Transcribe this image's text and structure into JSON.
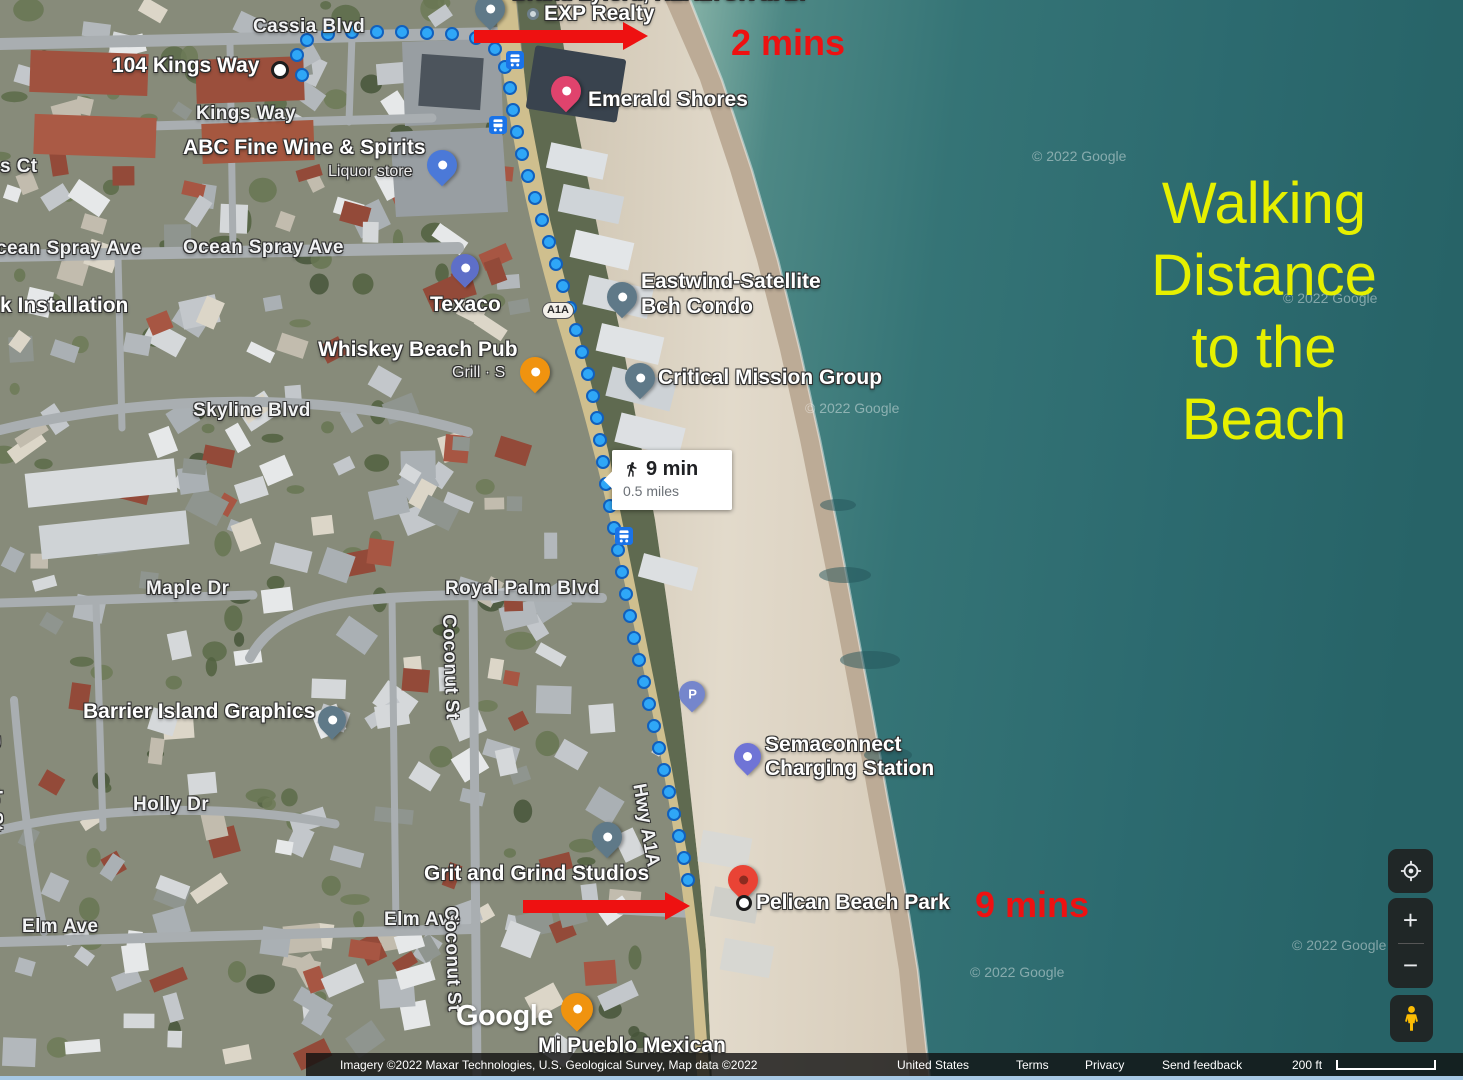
{
  "annotations": {
    "headline": [
      "Walking",
      "Distance",
      "to the",
      "Beach"
    ],
    "headline_color": "#e6f000",
    "arrow_color": "#ee1111",
    "walk_labels": [
      {
        "text": "2 mins",
        "x": 731,
        "y": 22
      },
      {
        "text": "9 mins",
        "x": 975,
        "y": 884
      }
    ],
    "arrows": [
      {
        "x": 474,
        "y": 30,
        "len": 150
      },
      {
        "x": 523,
        "y": 900,
        "len": 143
      }
    ]
  },
  "tooltip": {
    "duration": "9 min",
    "distance": "0.5 miles"
  },
  "route": {
    "color": "#2fa7f7",
    "dots": [
      [
        302,
        75
      ],
      [
        297,
        55
      ],
      [
        307,
        40
      ],
      [
        328,
        34
      ],
      [
        352,
        32
      ],
      [
        377,
        32
      ],
      [
        402,
        32
      ],
      [
        427,
        33
      ],
      [
        452,
        34
      ],
      [
        476,
        38
      ],
      [
        495,
        49
      ],
      [
        505,
        67
      ],
      [
        510,
        88
      ],
      [
        513,
        110
      ],
      [
        517,
        132
      ],
      [
        522,
        154
      ],
      [
        528,
        176
      ],
      [
        535,
        198
      ],
      [
        542,
        220
      ],
      [
        549,
        242
      ],
      [
        556,
        264
      ],
      [
        563,
        286
      ],
      [
        570,
        308
      ],
      [
        576,
        330
      ],
      [
        582,
        352
      ],
      [
        588,
        374
      ],
      [
        593,
        396
      ],
      [
        597,
        418
      ],
      [
        600,
        440
      ],
      [
        603,
        462
      ],
      [
        606,
        484
      ],
      [
        610,
        506
      ],
      [
        614,
        528
      ],
      [
        618,
        550
      ],
      [
        622,
        572
      ],
      [
        626,
        594
      ],
      [
        630,
        616
      ],
      [
        634,
        638
      ],
      [
        639,
        660
      ],
      [
        644,
        682
      ],
      [
        649,
        704
      ],
      [
        654,
        726
      ],
      [
        659,
        748
      ],
      [
        664,
        770
      ],
      [
        669,
        792
      ],
      [
        674,
        814
      ],
      [
        679,
        836
      ],
      [
        684,
        858
      ],
      [
        688,
        880
      ]
    ]
  },
  "transit_stops": [
    [
      515,
      60
    ],
    [
      498,
      125
    ],
    [
      624,
      536
    ]
  ],
  "pins": [
    {
      "name": "exp-realty-pin",
      "x": 490,
      "y": 30,
      "color": "#5f7988",
      "size": 30
    },
    {
      "name": "emerald-shores-pin",
      "x": 566,
      "y": 112,
      "color": "#e0436d",
      "size": 30
    },
    {
      "name": "abc-store-pin",
      "x": 442,
      "y": 186,
      "color": "#4b79d8",
      "size": 30
    },
    {
      "name": "texaco-pin",
      "x": 465,
      "y": 288,
      "color": "#5e6fc8",
      "size": 28
    },
    {
      "name": "whiskey-pub-pin",
      "x": 535,
      "y": 393,
      "color": "#f0930f",
      "size": 30
    },
    {
      "name": "eastwind-pin",
      "x": 622,
      "y": 318,
      "color": "#5f7988",
      "size": 30
    },
    {
      "name": "critical-mission-pin",
      "x": 640,
      "y": 399,
      "color": "#5f7988",
      "size": 30
    },
    {
      "name": "barrier-island-pin",
      "x": 332,
      "y": 740,
      "color": "#5f7988",
      "size": 28
    },
    {
      "name": "parking-pin",
      "x": 692,
      "y": 712,
      "color": "#7586cc",
      "size": 26,
      "glyph": "P"
    },
    {
      "name": "semaconnect-pin",
      "x": 747,
      "y": 776,
      "color": "#6f74d6",
      "size": 27
    },
    {
      "name": "grit-grind-pin",
      "x": 607,
      "y": 858,
      "color": "#5f7988",
      "size": 30
    },
    {
      "name": "pelican-beach-pin",
      "x": 743,
      "y": 901,
      "color": "#e94335",
      "size": 30,
      "inner": "#8c2b20"
    },
    {
      "name": "mi-pueblo-pin",
      "x": 577,
      "y": 1032,
      "color": "#f0930f",
      "size": 32
    }
  ],
  "markers": [
    {
      "name": "route-start-marker",
      "x": 280,
      "y": 70,
      "r": 9
    },
    {
      "name": "pelican-point-marker",
      "x": 744,
      "y": 903,
      "r": 8
    }
  ],
  "labels": [
    {
      "name": "realtor-line",
      "text": "Brand Lyford, REALTOR at Br",
      "x": 512,
      "y": -18,
      "cls": "place-lg",
      "poi": true
    },
    {
      "name": "exp-realty",
      "text": "EXP Realty",
      "x": 527,
      "y": 2,
      "cls": "place-lg",
      "icon": true,
      "poi": true
    },
    {
      "name": "cassia-blvd",
      "text": "Cassia Blvd",
      "x": 253,
      "y": 16,
      "cls": "street"
    },
    {
      "name": "emerald-shores",
      "text": "Emerald Shores",
      "x": 588,
      "y": 88,
      "cls": "place-lg",
      "poi": true
    },
    {
      "name": "104-kings-way",
      "text": "104 Kings Way",
      "x": 112,
      "y": 54,
      "cls": "place",
      "poi": true
    },
    {
      "name": "kings-way",
      "text": "Kings Way",
      "x": 196,
      "y": 103,
      "cls": "street"
    },
    {
      "name": "abc-fine-wine",
      "text": "ABC Fine Wine & Spirits",
      "x": 183,
      "y": 136,
      "cls": "place-lg",
      "poi": true
    },
    {
      "name": "liquor-store",
      "text": "Liquor store",
      "x": 328,
      "y": 163,
      "cls": "sub"
    },
    {
      "name": "s-ct",
      "text": "s Ct",
      "x": 0,
      "y": 156,
      "cls": "street"
    },
    {
      "name": "ocean-spray-ave-w",
      "text": "cean Spray Ave",
      "x": -4,
      "y": 238,
      "cls": "street"
    },
    {
      "name": "ocean-spray-ave",
      "text": "Ocean Spray Ave",
      "x": 183,
      "y": 237,
      "cls": "street"
    },
    {
      "name": "k-installation",
      "text": "k Installation",
      "x": 0,
      "y": 294,
      "cls": "place"
    },
    {
      "name": "texaco",
      "text": "Texaco",
      "x": 430,
      "y": 293,
      "cls": "place-lg",
      "poi": true
    },
    {
      "name": "eastwind-line1",
      "text": "Eastwind-Satellite",
      "x": 641,
      "y": 270,
      "cls": "place-lg",
      "poi": true
    },
    {
      "name": "eastwind-line2",
      "text": "Bch Condo",
      "x": 641,
      "y": 295,
      "cls": "place-lg",
      "poi": true
    },
    {
      "name": "whiskey-beach-pub",
      "text": "Whiskey Beach Pub",
      "x": 318,
      "y": 338,
      "cls": "place-lg",
      "poi": true
    },
    {
      "name": "grill-s",
      "text": "Grill · S",
      "x": 452,
      "y": 364,
      "cls": "sub"
    },
    {
      "name": "critical-mission-group",
      "text": "Critical Mission Group",
      "x": 658,
      "y": 366,
      "cls": "place-lg",
      "poi": true
    },
    {
      "name": "skyline-blvd",
      "text": "Skyline Blvd",
      "x": 193,
      "y": 400,
      "cls": "street"
    },
    {
      "name": "maple-dr",
      "text": "Maple Dr",
      "x": 146,
      "y": 578,
      "cls": "street"
    },
    {
      "name": "royal-palm-blvd",
      "text": "Royal Palm Blvd",
      "x": 445,
      "y": 578,
      "cls": "street"
    },
    {
      "name": "coconut-st-n",
      "text": "Coconut St",
      "x": 459,
      "y": 614,
      "cls": "street",
      "rot": 88
    },
    {
      "name": "barrier-island-graphics",
      "text": "Barrier Island Graphics",
      "x": 83,
      "y": 700,
      "cls": "place-lg",
      "poi": true
    },
    {
      "name": "semaconnect-line1",
      "text": "Semaconnect",
      "x": 765,
      "y": 733,
      "cls": "place-lg",
      "poi": true
    },
    {
      "name": "semaconnect-line2",
      "text": "Charging Station",
      "x": 765,
      "y": 757,
      "cls": "place-lg",
      "poi": true
    },
    {
      "name": "holly-dr",
      "text": "Holly Dr",
      "x": 133,
      "y": 794,
      "cls": "street"
    },
    {
      "name": "rosada-st",
      "text": "Rosada St",
      "x": 3,
      "y": 735,
      "cls": "street",
      "rot": 88
    },
    {
      "name": "hwy-a1a",
      "text": "Hwy A1A",
      "x": 649,
      "y": 782,
      "cls": "street",
      "rot": 80
    },
    {
      "name": "grit-and-grind-studios",
      "text": "Grit and Grind Studios",
      "x": 424,
      "y": 862,
      "cls": "place-lg",
      "poi": true
    },
    {
      "name": "elm-ave-w",
      "text": "Elm Ave",
      "x": 22,
      "y": 916,
      "cls": "street"
    },
    {
      "name": "elm-ave-e",
      "text": "Elm Ave",
      "x": 384,
      "y": 909,
      "cls": "street"
    },
    {
      "name": "coconut-st-s",
      "text": "Coconut St",
      "x": 461,
      "y": 906,
      "cls": "street",
      "rot": 88
    },
    {
      "name": "pelican-beach-park",
      "text": "Pelican Beach Park",
      "x": 756,
      "y": 891,
      "cls": "place-lg",
      "poi": true
    },
    {
      "name": "mi-pueblo-mexican",
      "text": "Mi Pueblo Mexican",
      "x": 538,
      "y": 1034,
      "cls": "place-lg",
      "poi": true
    }
  ],
  "watermarks": {
    "text": "© 2022 Google",
    "positions": [
      [
        1032,
        148
      ],
      [
        1283,
        290
      ],
      [
        805,
        400
      ],
      [
        970,
        964
      ],
      [
        1292,
        937
      ]
    ]
  },
  "badge": {
    "text": "A1A"
  },
  "logo": {
    "text": "Google"
  },
  "controls": {
    "zoom_in": "+",
    "zoom_out": "−"
  },
  "attribution": {
    "imagery": "Imagery ©2022 Maxar Technologies, U.S. Geological Survey, Map data ©2022",
    "country": "United States",
    "terms": "Terms",
    "privacy": "Privacy",
    "feedback": "Send feedback",
    "scale": "200 ft"
  }
}
